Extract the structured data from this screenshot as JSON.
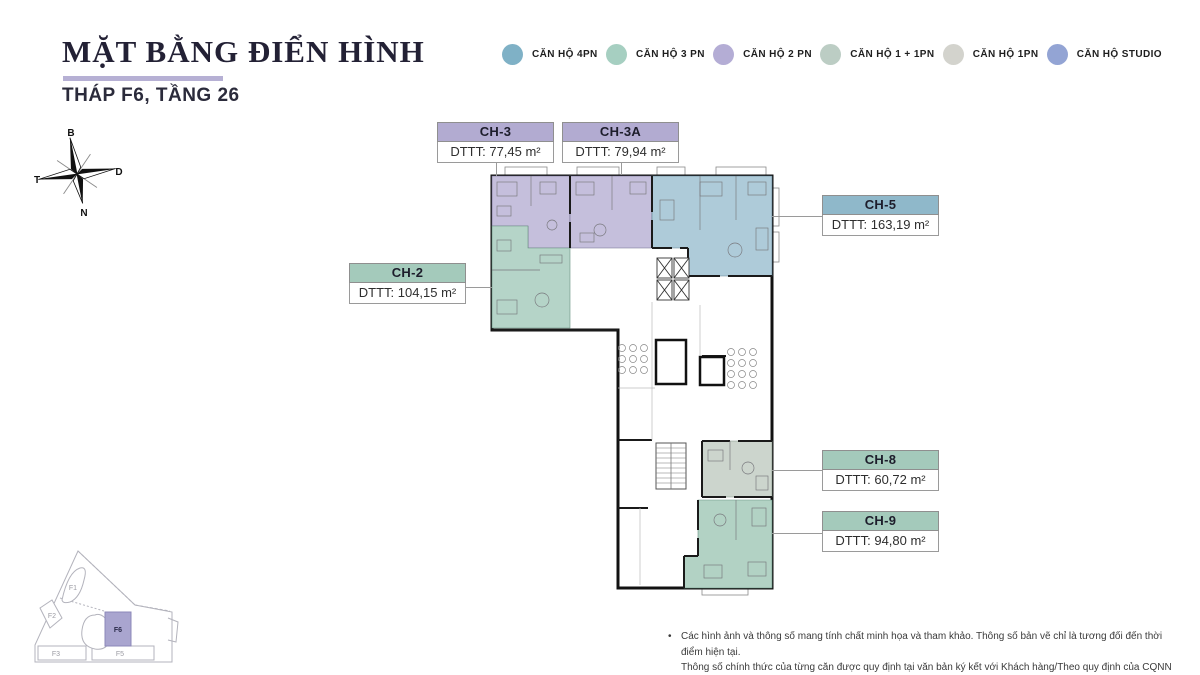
{
  "header": {
    "title": "MẶT BẰNG ĐIỂN HÌNH",
    "subtitle": "THÁP F6, TẦNG 26"
  },
  "legend": {
    "items": [
      {
        "label": "CĂN HỘ 4PN",
        "color": "#7fb1c6"
      },
      {
        "label": "CĂN HỘ 3 PN",
        "color": "#a6cfc1"
      },
      {
        "label": "CĂN HỘ 2 PN",
        "color": "#b4add5"
      },
      {
        "label": "CĂN HỘ 1 + 1PN",
        "color": "#bccdc4"
      },
      {
        "label": "CĂN HỘ 1PN",
        "color": "#d3d3cd"
      },
      {
        "label": "CĂN HỘ STUDIO",
        "color": "#93a4d4"
      }
    ]
  },
  "compass": {
    "north": "B",
    "east": "D",
    "west": "T",
    "south": "N"
  },
  "units": [
    {
      "id": "CH-3",
      "area": "DTTT: 77,45 m²",
      "header_color": "#b2abd1",
      "fill": "#c5bfdc"
    },
    {
      "id": "CH-3A",
      "area": "DTTT: 79,94 m²",
      "header_color": "#b2abd1",
      "fill": "#c5bfdc"
    },
    {
      "id": "CH-5",
      "area": "DTTT: 163,19 m²",
      "header_color": "#8fb8ca",
      "fill": "#aecbd9"
    },
    {
      "id": "CH-2",
      "area": "DTTT: 104,15 m²",
      "header_color": "#a4cabb",
      "fill": "#b5d4c8"
    },
    {
      "id": "CH-8",
      "area": "DTTT: 60,72 m²",
      "header_color": "#a4cabb",
      "fill": "#ccd5cd"
    },
    {
      "id": "CH-9",
      "area": "DTTT: 94,80 m²",
      "header_color": "#a4cabb",
      "fill": "#b2d2c4"
    }
  ],
  "site_plan": {
    "buildings": {
      "f1": "F1",
      "f2": "F2",
      "f3": "F3",
      "f5": "F5",
      "f6": "F6"
    },
    "highlighted": "F6",
    "highlight_color": "#a9a5cf"
  },
  "footer": {
    "bullet": "•",
    "line1": "Các hình ảnh và thông số mang tính chất minh họa và tham khảo. Thông số bản vẽ chỉ là tương đối đến thời điểm hiện tại.",
    "line2": "Thông số chính thức của từng căn được quy định tại văn bản ký kết với Khách hàng/Theo quy định của CQNN"
  }
}
